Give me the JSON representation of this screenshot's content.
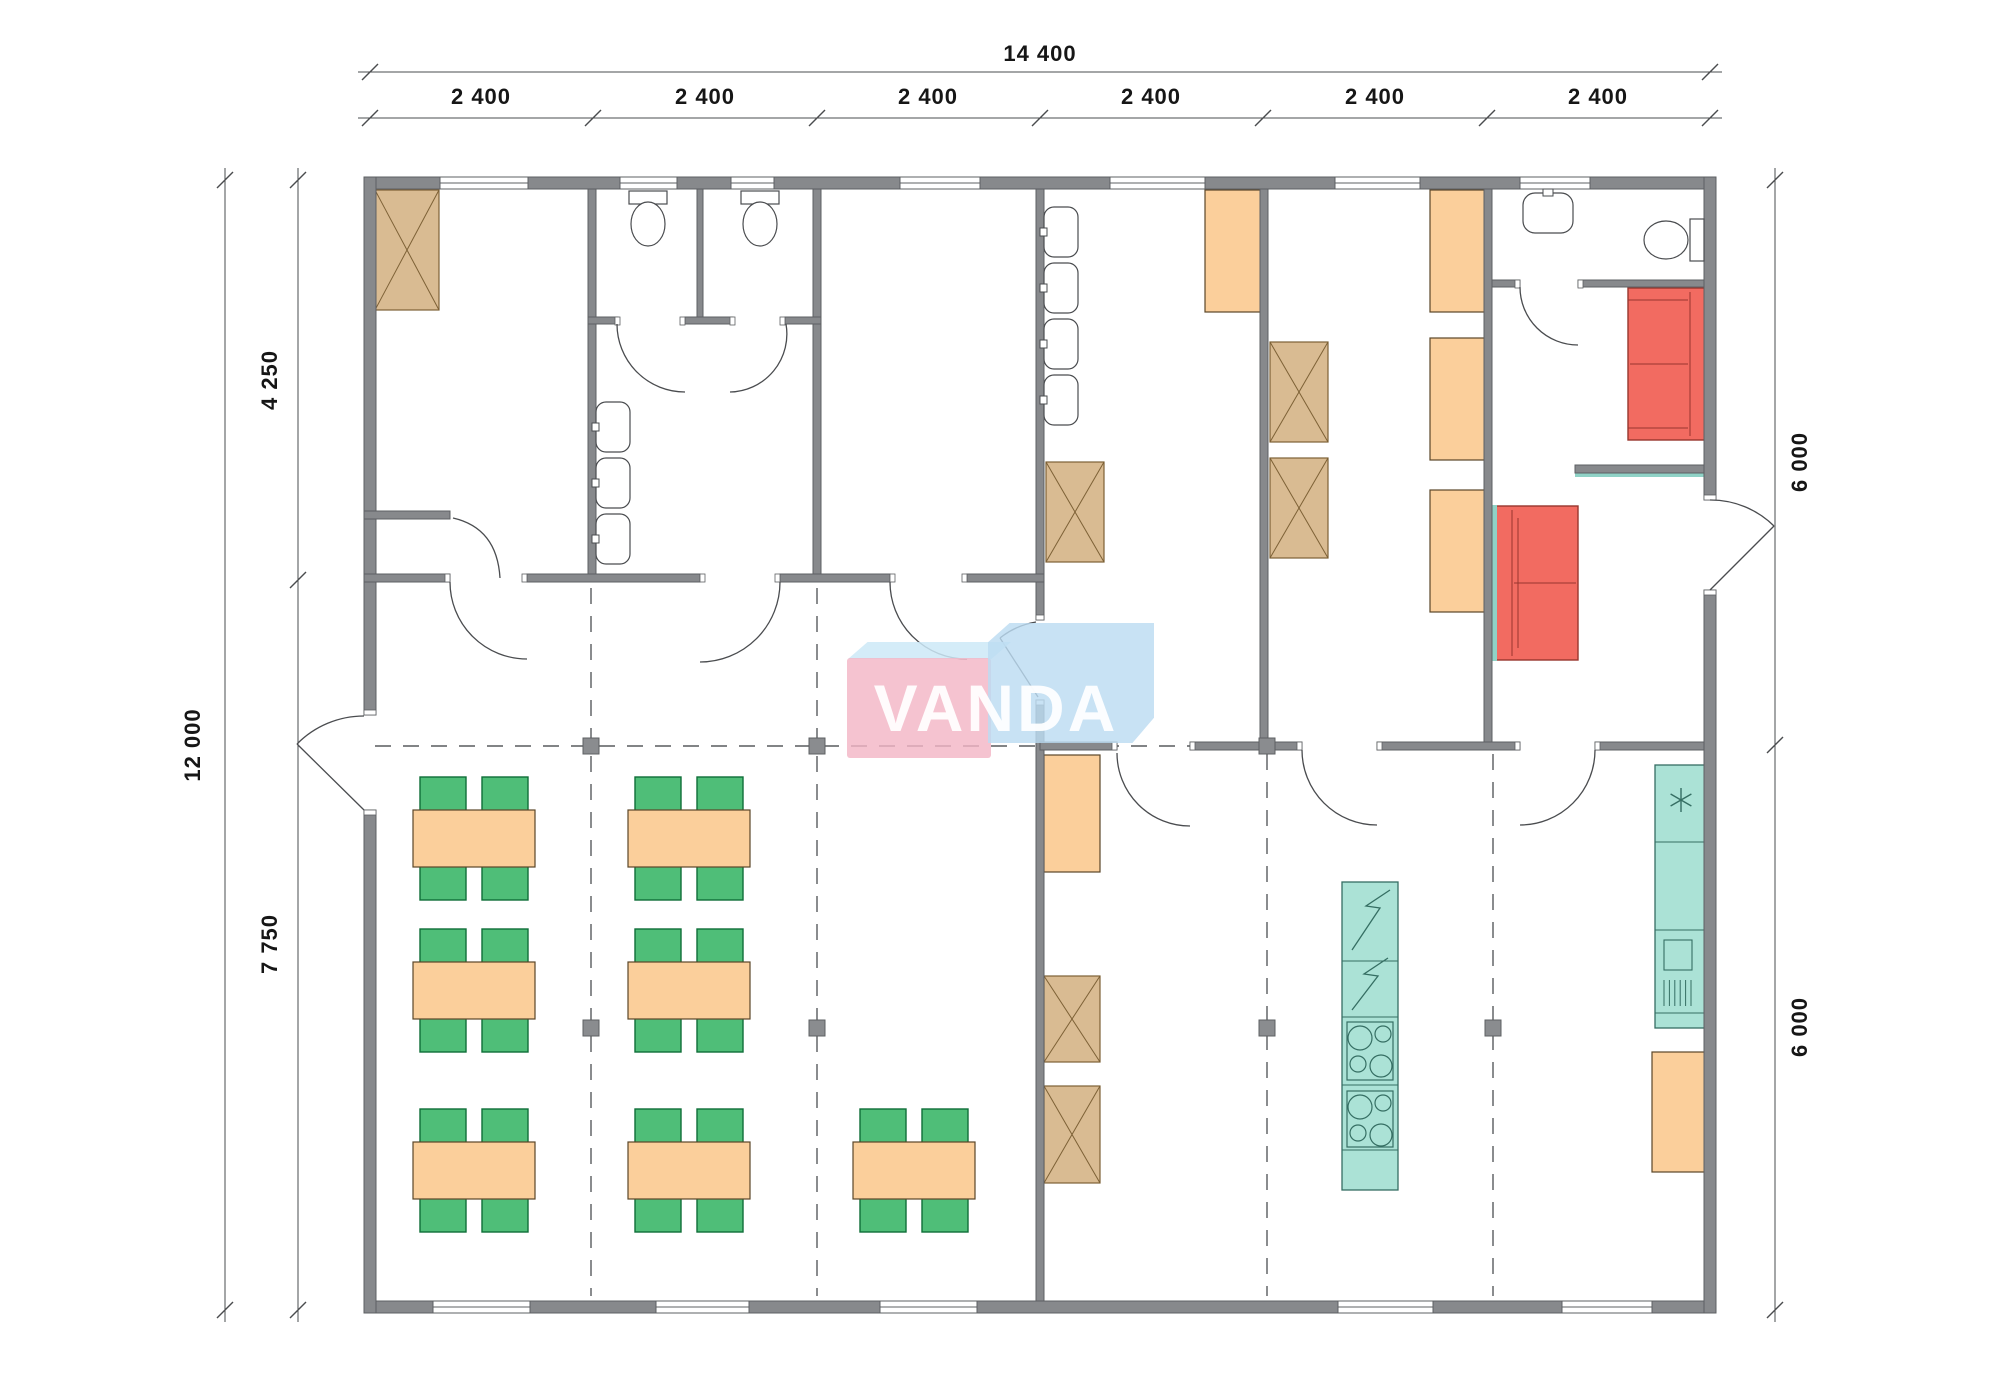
{
  "watermark": {
    "text": "VANDA"
  },
  "dimensions": {
    "top_total": "14 400",
    "top_segments": [
      "2 400",
      "2 400",
      "2 400",
      "2 400",
      "2 400",
      "2 400"
    ],
    "left_total": "12 000",
    "left_top": "4 250",
    "left_bottom": "7 750",
    "right_top": "6 000",
    "right_bottom": "6 000"
  },
  "colors": {
    "wall_fill": "#87898c",
    "wall_edge": "#5e6063",
    "line": "#4a4c4f",
    "dash": "#595b5e",
    "marker_fill": "#8a8c8f",
    "tan_box_fill": "#d9bb92",
    "tan_box_edge": "#7d6136",
    "orange_fill": "#fbcf9b",
    "orange_edge": "#5b4628",
    "chair_fill": "#4fbe78",
    "chair_edge": "#0f6e38",
    "sofa_fill": "#f26b61",
    "sofa_edge": "#98362e",
    "teal_fill": "#abe2d6",
    "teal_edge": "#356e63",
    "teal_strip": "#8fd2c6",
    "watermark_pink": "#f3b6c6",
    "watermark_blue": "#bcdcf2",
    "dimension_text": "#161616"
  },
  "inventory": {
    "dining_tables": 7,
    "chairs": 28,
    "toilets": 3,
    "washbasins": 8,
    "sofas": 2,
    "crossed_storage_boxes": 6,
    "wardrobe_units": 6,
    "kitchen_stove_hobs": 2,
    "kitchen_appliance_units": 2
  }
}
